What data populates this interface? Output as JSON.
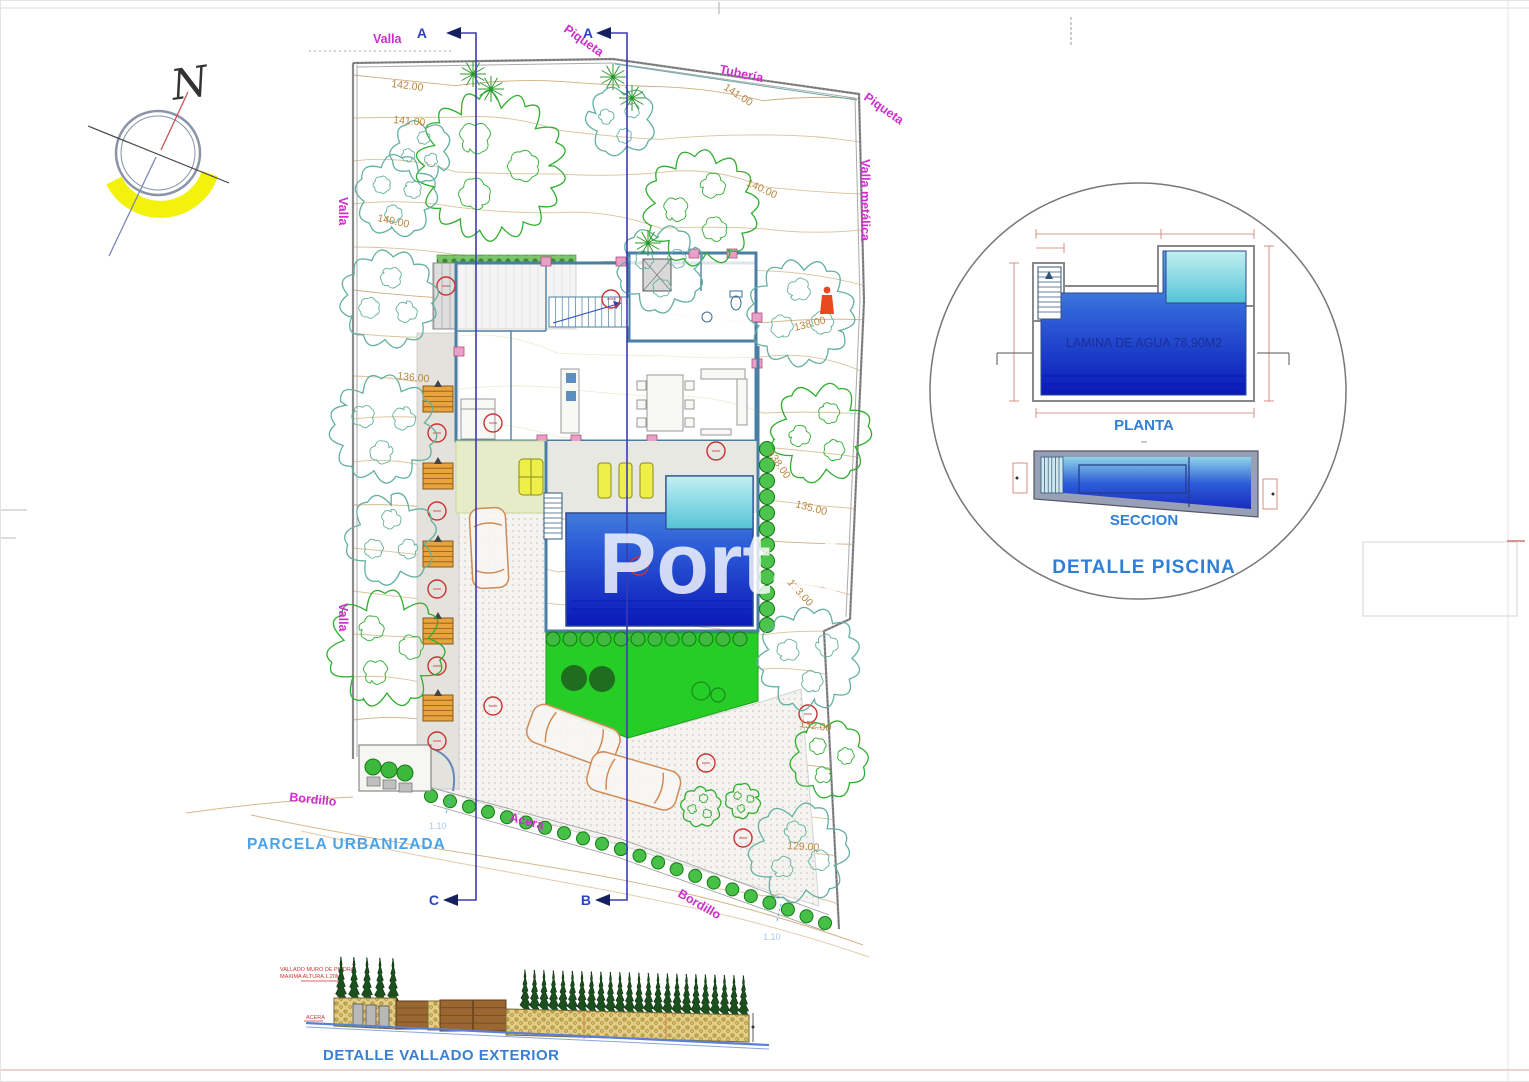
{
  "compass": {
    "north_label": "N"
  },
  "watermark": {
    "text": "Portal"
  },
  "site_plan": {
    "boundary_labels": {
      "valla_top": "Valla",
      "piqueta_top": "Piqueta",
      "tuberia": "Tubería",
      "piqueta_right": "Piqueta",
      "valla_metalica": "Valla metálica",
      "valla_left_upper": "Valla",
      "valla_left_lower": "Valla",
      "bordillo_left": "Bordillo",
      "acera": "Acera",
      "bordillo_bottom_right": "Bordillo",
      "parcela_urbanizada": "PARCELA URBANIZADA"
    },
    "section_markers": {
      "a_left": "A",
      "a_right": "A",
      "c": "C",
      "b": "B"
    },
    "contour_labels": [
      "142.00",
      "141.00",
      "141.00",
      "140.00",
      "140.00",
      "138.00",
      "138.00",
      "136.00",
      "135.00",
      "133.00",
      "132.00",
      "129.00"
    ],
    "dimension_labels": [
      "1.10",
      "1.10"
    ]
  },
  "pool_detail": {
    "water_area_label": "LAMINA DE AGUA 78,90M2",
    "plan_label": "PLANTA",
    "section_label": "SECCION",
    "title": "DETALLE PISCINA"
  },
  "fence_detail": {
    "note_line1": "VALLADO MURO DE PIEDRA",
    "note_line2": "MAXIMA ALTURA 1,20M",
    "acera_label": "ACERA",
    "title": "DETALLE VALLADO EXTERIOR"
  },
  "colors": {
    "label_magenta": "#cc2fcc",
    "cad_blue": "#2b45c0",
    "title_blue": "#3f9be0",
    "contour_tan": "#b9863f",
    "tree_green": "#2fae2f",
    "tree_teal": "#63b0a0",
    "pool_deep": "#0a18b8",
    "pool_light": "#5a9fe0",
    "lawn_green": "#26cd26",
    "wall_blue": "#4a7fa5",
    "wood_orange": "#e8a33d",
    "marker_red": "#cc3333"
  }
}
